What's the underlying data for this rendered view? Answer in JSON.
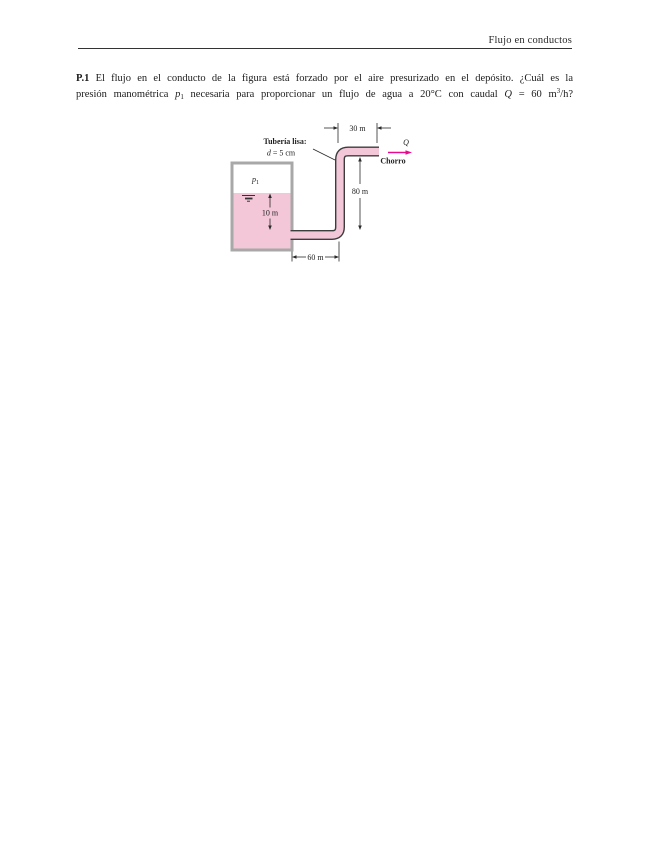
{
  "header": {
    "title": "Flujo en conductos"
  },
  "problem": {
    "number": "P.1",
    "line1": " El flujo en el conducto de la figura está forzado por el aire presurizado en el depósito. ¿Cuál es la",
    "line2_a": "presión manométrica ",
    "p_var": "p",
    "p_sub": "1",
    "line2_b": " necesaria para proporcionar un flujo de agua a 20°C con caudal ",
    "q_var": "Q",
    "line2_c": " = 60 m",
    "exp": "3",
    "line2_d": "/h?"
  },
  "figure": {
    "pipe_label_title": "Tubería lisa:",
    "pipe_label_var": "d",
    "pipe_label_value": "= 5 cm",
    "dim_top": "30 m",
    "dim_height": "80 m",
    "dim_bottom": "60 m",
    "dim_depth": "10 m",
    "pressure_var": "p",
    "pressure_sub": "1",
    "flow_var": "Q",
    "jet_label": "Chorro",
    "colors": {
      "water": "#f3c7d8",
      "wall": "#a8a8a8",
      "pipe_edge": "#3d3d3d",
      "arrow": "#e80c8c"
    }
  }
}
